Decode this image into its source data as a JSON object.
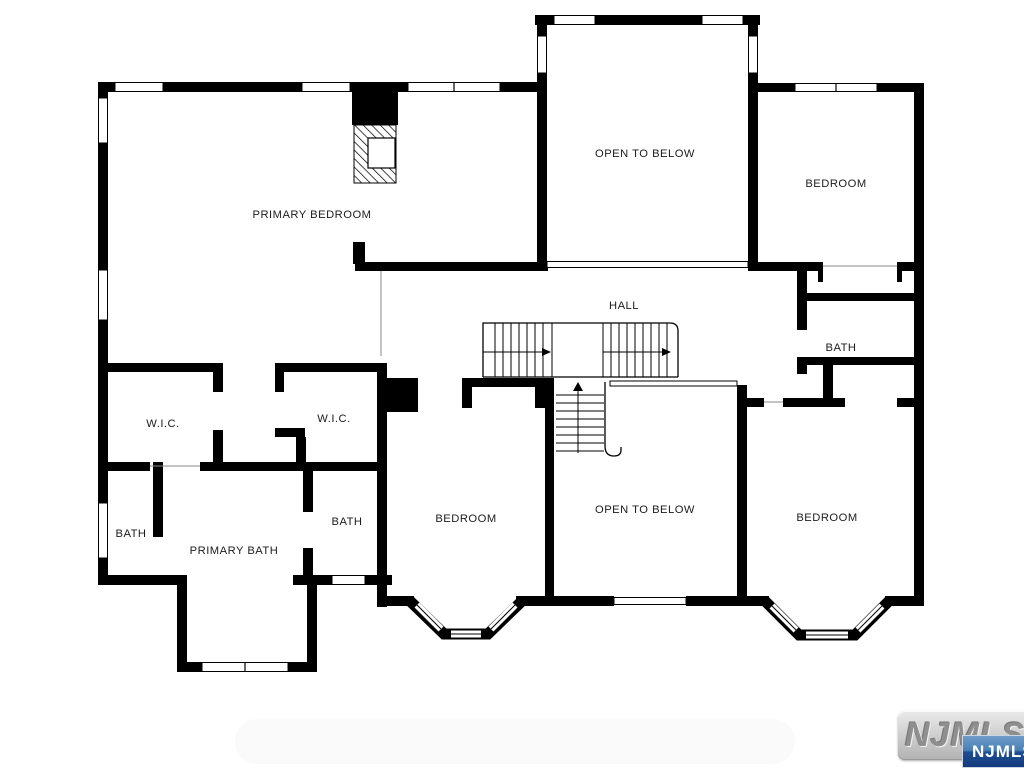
{
  "plan": {
    "rooms": [
      {
        "id": "primary-bedroom",
        "label": "PRIMARY BEDROOM"
      },
      {
        "id": "open-to-below-top",
        "label": "OPEN TO BELOW"
      },
      {
        "id": "bedroom-top-right",
        "label": "BEDROOM"
      },
      {
        "id": "hall",
        "label": "HALL"
      },
      {
        "id": "bath-right",
        "label": "BATH"
      },
      {
        "id": "wic-left",
        "label": "W.I.C."
      },
      {
        "id": "wic-right",
        "label": "W.I.C."
      },
      {
        "id": "bath-left",
        "label": "BATH"
      },
      {
        "id": "primary-bath",
        "label": "PRIMARY BATH"
      },
      {
        "id": "bath-middle",
        "label": "BATH"
      },
      {
        "id": "bedroom-bottom-middle",
        "label": "BEDROOM"
      },
      {
        "id": "open-to-below-bottom",
        "label": "OPEN TO BELOW"
      },
      {
        "id": "bedroom-bottom-right",
        "label": "BEDROOM"
      }
    ],
    "colors": {
      "wall": "#000000",
      "background": "#ffffff",
      "label_text": "#1c1c1c"
    }
  },
  "watermark": {
    "plate_text": "NJMLS",
    "badge_text": "NJMLS",
    "plate_gray": "#b2b2b2",
    "plate_text_gray": "#8f8f8f",
    "badge_blue_top": "#6f9cc9",
    "badge_blue_bottom": "#143a7e",
    "badge_text_color": "#ffffff"
  }
}
